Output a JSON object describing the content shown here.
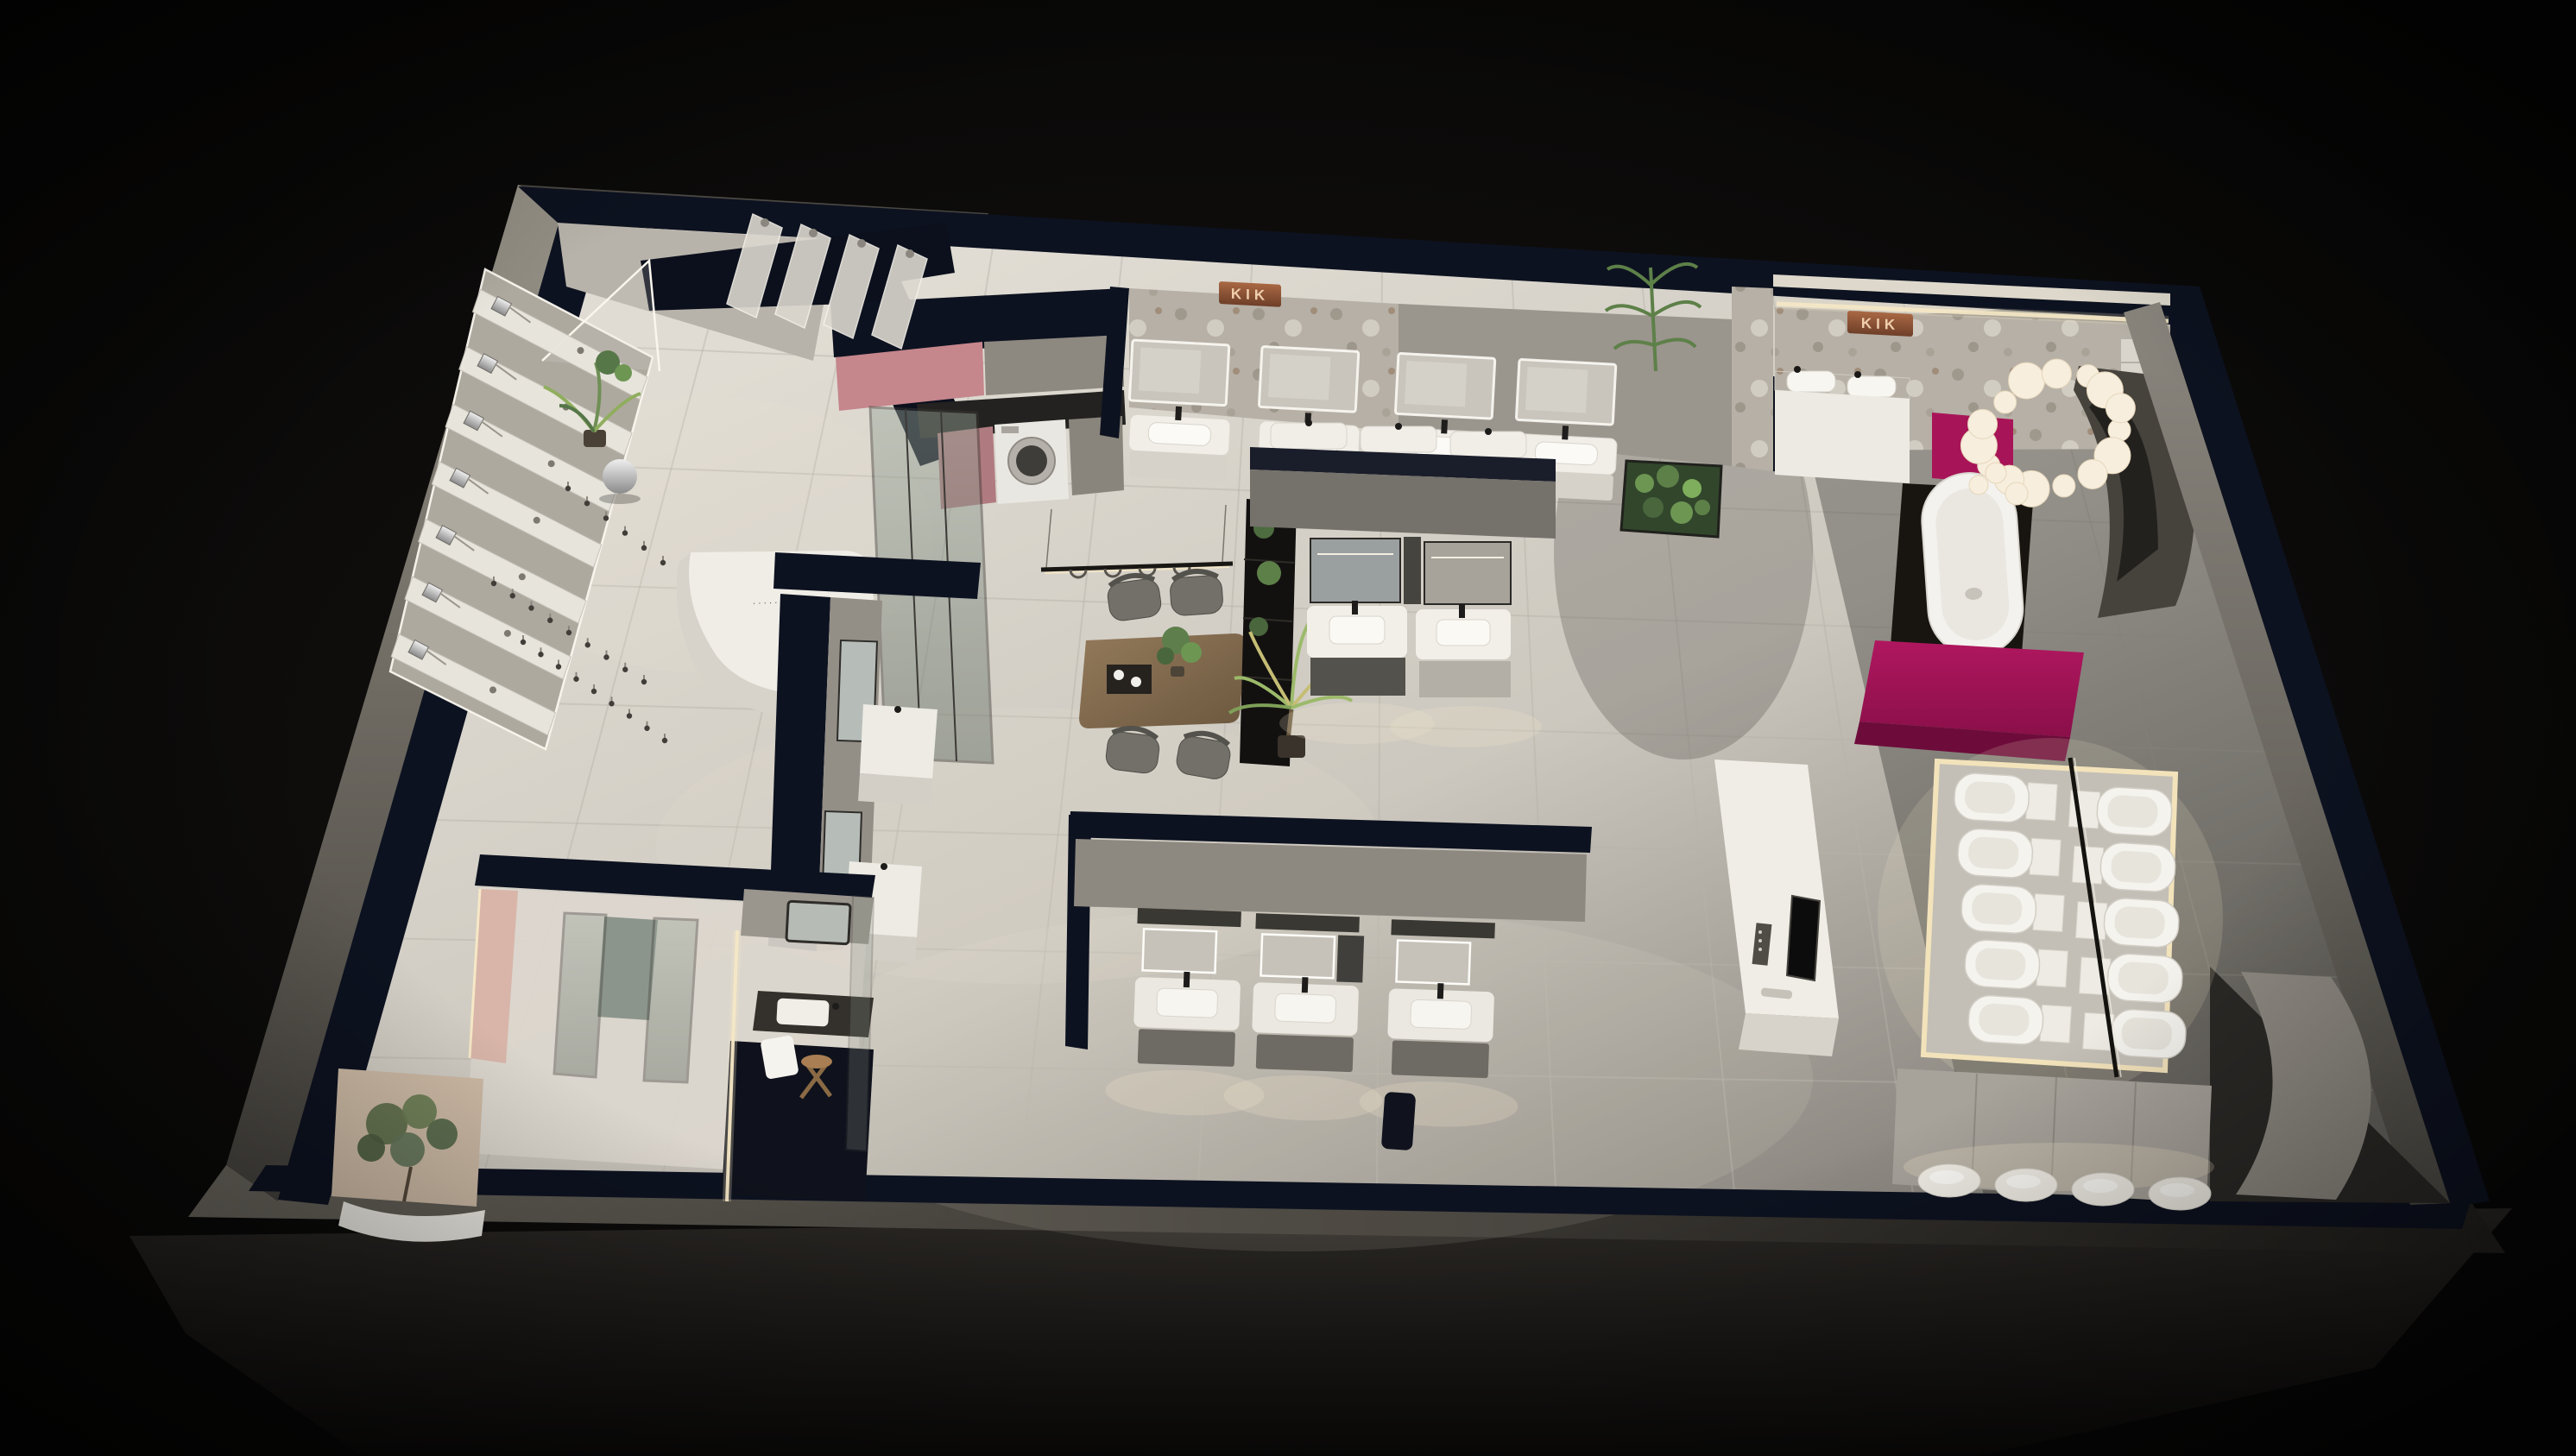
{
  "scene": {
    "subject": "bathroom-sanitaryware-showroom-floorplan-render"
  },
  "brand": {
    "sign_text": "KIK"
  },
  "reception": {
    "desk_marks": "····· ······"
  },
  "colors": {
    "bg": "#070707",
    "navy": "#0d1220",
    "floor-light": "#e3dfd6",
    "floor-mid": "#cbc7be",
    "floor-dark": "#8f8b83",
    "wall-face": "#b3aea5",
    "wall-outer": "#8d8981",
    "cut-face": "#5a564f",
    "marble": "#b6b0a6",
    "copper": "#8a5236",
    "copper-text": "#f0cfae",
    "pink": "#c5868c",
    "blush": "#d8b3a6",
    "taupe": "#8f8a82",
    "magenta": "#a81458",
    "magenta-dark": "#6d0c3a",
    "wood": "#8a7156",
    "green": "#5d7d4a",
    "green-light": "#8fae5e",
    "glass": "#7c857a",
    "led": "#f6e8c6",
    "white": "#f2efe9",
    "chrome": "#c9c9c9",
    "cabinet": "#6f6b65",
    "dark": "#17150f"
  },
  "displays": {
    "shower_panel_count": 7,
    "upper_shower_panel_count": 4,
    "faucet_sample_count": 24,
    "toilet_grid": {
      "rows": 5,
      "cols": 2
    },
    "bottom_basin_count": 4,
    "chandelier_bulb_count": 18,
    "mirror_vanity_row_count": 3,
    "top_vanity_positions": [
      1312,
      1462,
      1620,
      1760
    ],
    "meeting_chairs": [
      [
        1314,
        695,
        -8
      ],
      [
        1386,
        690,
        -4
      ],
      [
        1312,
        872,
        7
      ],
      [
        1394,
        878,
        10
      ]
    ]
  }
}
